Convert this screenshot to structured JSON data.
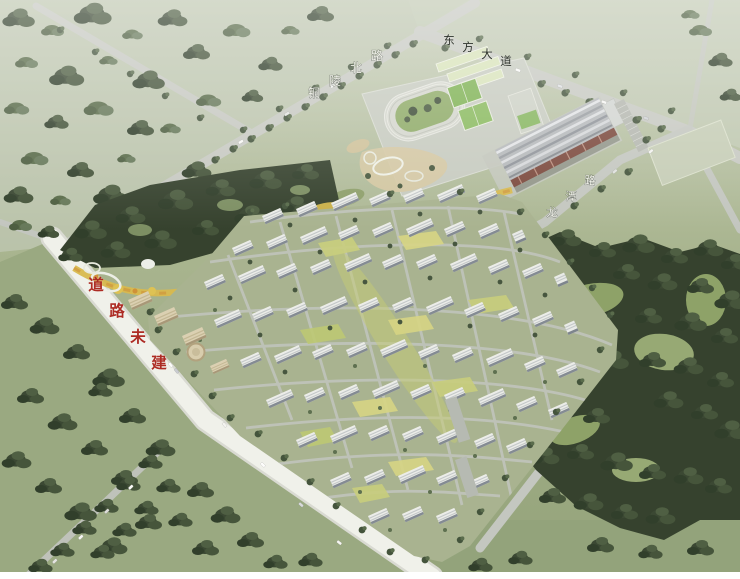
{
  "image": {
    "title": "aerial masterplan rendering of residential development",
    "labels": {
      "road_northwest": "铜陵北路",
      "road_north": "东方大道",
      "road_east": "龙潭路",
      "road_southwest_status": "道路未建"
    },
    "palette": {
      "field_pale": "#bcc5ae",
      "field_green": "#9dab83",
      "forest_dark": "#36422e",
      "road_gray": "#c7c9c2",
      "road_unbuilt_white": "#f0f1ea",
      "building_white": "#ecede9",
      "ribbon_yellow": "#d8b94e",
      "track_infield": "#8fab68",
      "court_green": "#7fb254",
      "factory_wall": "#7c4a3e",
      "label_red": "#ad2c24",
      "label_light": "#f1f2ea",
      "label_dark": "#2d322c"
    }
  }
}
